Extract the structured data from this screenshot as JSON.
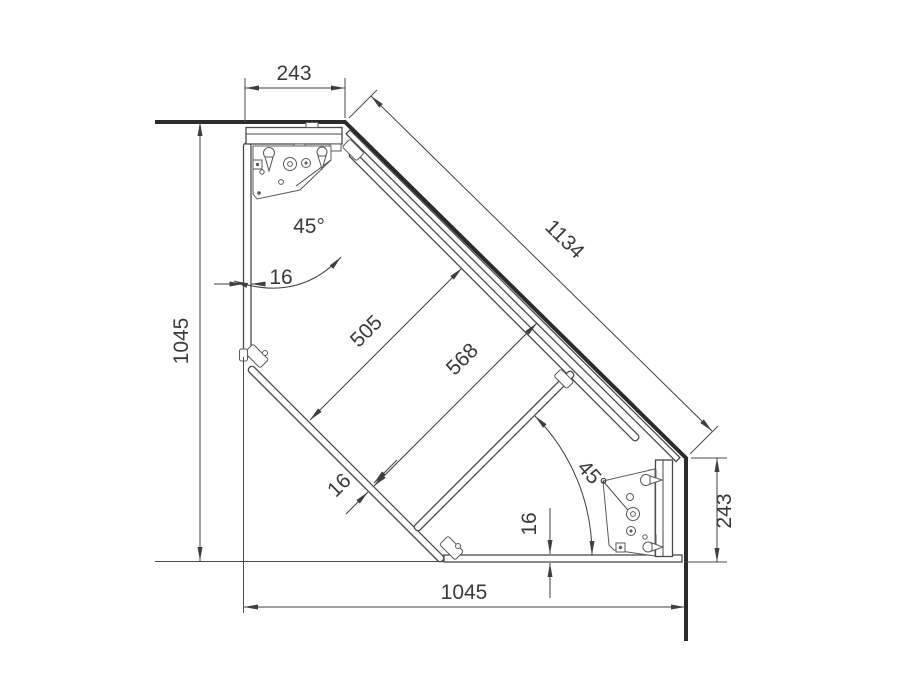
{
  "drawing": {
    "dimensions": {
      "top_width": "243",
      "diagonal_front": "1134",
      "left_height": "1045",
      "left_panel_thickness": "16",
      "angle_top": "45°",
      "inner_depth_1": "505",
      "inner_depth_2": "568",
      "door_thickness": "16",
      "angle_bottom": "45°",
      "bottom_panel_thickness": "16",
      "right_width": "243",
      "bottom_width": "1045"
    },
    "colors": {
      "line": "#4a4a4a",
      "wall": "#2b2b2b",
      "background": "#ffffff"
    }
  }
}
